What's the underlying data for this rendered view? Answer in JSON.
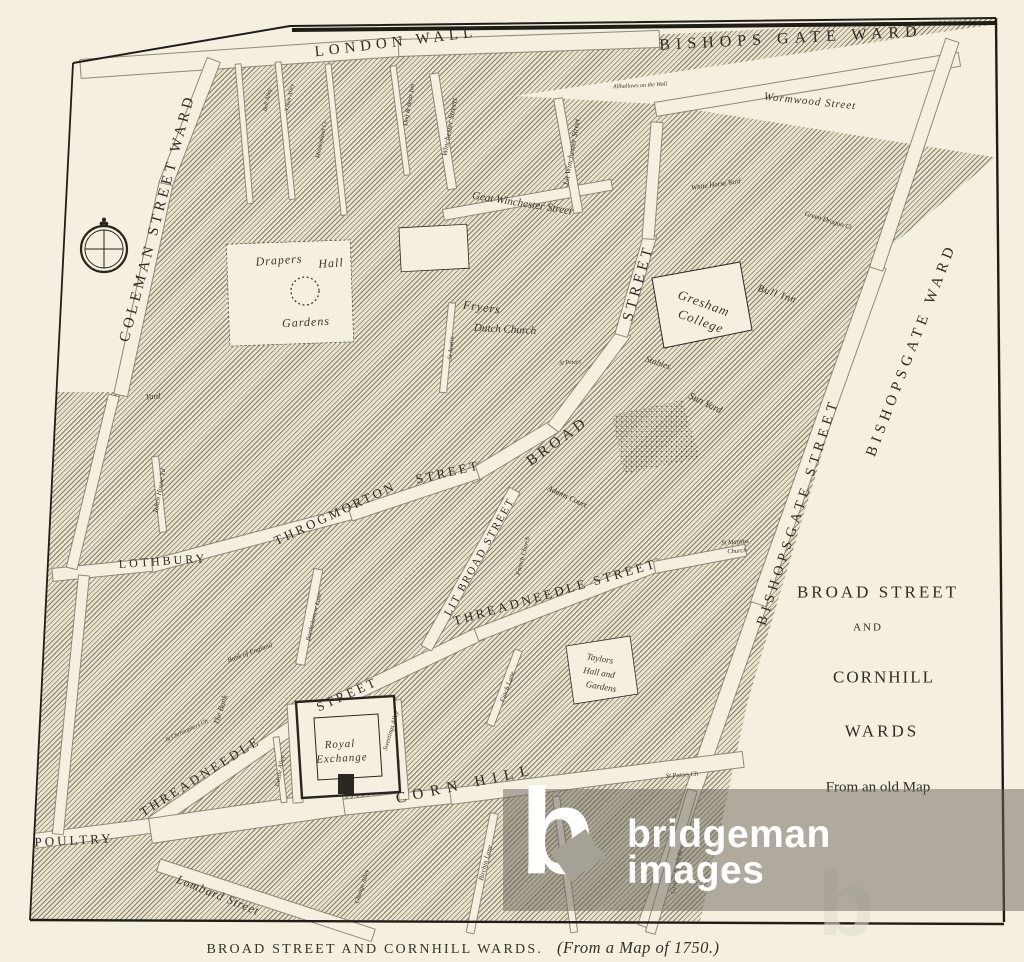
{
  "caption": {
    "title": "BROAD STREET AND CORNHILL WARDS.",
    "source": "(From a Map of 1750.)"
  },
  "watermark": {
    "logo_letter": "b",
    "line1": "bridgeman",
    "line2": "images",
    "ghost_letter": "b"
  },
  "map": {
    "labels": [
      {
        "t": "LONDON WALL",
        "x": 396,
        "y": 43,
        "r": -7,
        "s": 15,
        "ls": 5,
        "st": "c"
      },
      {
        "t": "BISHOPS GATE WARD",
        "x": 791,
        "y": 39,
        "r": -3,
        "s": 16,
        "ls": 6,
        "st": "c"
      },
      {
        "t": "COLEMAN STREET WARD",
        "x": 158,
        "y": 218,
        "r": -75,
        "s": 15,
        "ls": 4,
        "st": "c"
      },
      {
        "t": "BISHOPSGATE STREET",
        "x": 799,
        "y": 512,
        "r": -72,
        "s": 14,
        "ls": 5,
        "st": "c"
      },
      {
        "t": "BISHOPSGATE WARD",
        "x": 912,
        "y": 350,
        "r": -69,
        "s": 15,
        "ls": 5,
        "st": "c"
      },
      {
        "t": "BROAD",
        "x": 558,
        "y": 442,
        "r": -36,
        "s": 15,
        "ls": 4,
        "st": "c"
      },
      {
        "t": "STREET",
        "x": 639,
        "y": 283,
        "r": -74,
        "s": 15,
        "ls": 4,
        "st": "c"
      },
      {
        "t": "THROGMORTON",
        "x": 335,
        "y": 513,
        "r": -25,
        "s": 13,
        "ls": 3,
        "st": "c"
      },
      {
        "t": "STREET",
        "x": 448,
        "y": 472,
        "r": -13,
        "s": 13,
        "ls": 3,
        "st": "c"
      },
      {
        "t": "LOTHBURY",
        "x": 163,
        "y": 561,
        "r": -4,
        "s": 12,
        "ls": 3,
        "st": "c"
      },
      {
        "t": "LIT BROAD STREET",
        "x": 480,
        "y": 557,
        "r": -61,
        "s": 11,
        "ls": 2,
        "st": "c"
      },
      {
        "t": "THREADNEEDLE STREET",
        "x": 555,
        "y": 592,
        "r": -16,
        "s": 13,
        "ls": 3,
        "st": "c"
      },
      {
        "t": "THREADNEEDLE",
        "x": 200,
        "y": 776,
        "r": -32,
        "s": 13,
        "ls": 3,
        "st": "c"
      },
      {
        "t": "STREET",
        "x": 347,
        "y": 694,
        "r": -24,
        "s": 13,
        "ls": 3,
        "st": "c"
      },
      {
        "t": "CORN HILL",
        "x": 466,
        "y": 785,
        "r": -12,
        "s": 15,
        "ls": 7,
        "st": "c"
      },
      {
        "t": "POULTRY",
        "x": 74,
        "y": 840,
        "r": -3,
        "s": 13,
        "ls": 3,
        "st": "c"
      },
      {
        "t": "BROAD STREET",
        "x": 878,
        "y": 592,
        "r": 0,
        "s": 17,
        "ls": 3,
        "st": "c"
      },
      {
        "t": "AND",
        "x": 868,
        "y": 628,
        "r": 0,
        "s": 11,
        "ls": 2,
        "st": "c"
      },
      {
        "t": "CORNHILL",
        "x": 884,
        "y": 677,
        "r": 0,
        "s": 17,
        "ls": 2,
        "st": "c"
      },
      {
        "t": "WARDS",
        "x": 882,
        "y": 731,
        "r": 0,
        "s": 17,
        "ls": 3,
        "st": "c"
      },
      {
        "t": "From an old Map",
        "x": 878,
        "y": 788,
        "r": 0,
        "s": 15,
        "ls": 0,
        "st": "p"
      },
      {
        "t": "Wormwood Street",
        "x": 810,
        "y": 102,
        "r": 6,
        "s": 11,
        "ls": 1,
        "st": "s"
      },
      {
        "t": "Allhallows on the Wall",
        "x": 640,
        "y": 86,
        "r": -3,
        "s": 6,
        "ls": 0,
        "st": "s"
      },
      {
        "t": "Geat Winchester Street",
        "x": 522,
        "y": 204,
        "r": 9,
        "s": 11,
        "ls": 0,
        "st": "s"
      },
      {
        "t": "Lit Winchester Street",
        "x": 572,
        "y": 152,
        "r": -80,
        "s": 8,
        "ls": 0,
        "st": "s"
      },
      {
        "t": "Winchester Streets",
        "x": 450,
        "y": 127,
        "r": -80,
        "s": 8,
        "ls": 0,
        "st": "s"
      },
      {
        "t": "Dog & Bear Inn",
        "x": 410,
        "y": 105,
        "r": -80,
        "s": 6.5,
        "ls": 0,
        "st": "s"
      },
      {
        "t": "Drapers",
        "x": 279,
        "y": 260,
        "r": -4,
        "s": 12,
        "ls": 1,
        "st": "s"
      },
      {
        "t": "Hall",
        "x": 331,
        "y": 263,
        "r": -4,
        "s": 12,
        "ls": 1,
        "st": "s"
      },
      {
        "t": "Gardens",
        "x": 306,
        "y": 322,
        "r": -3,
        "s": 12,
        "ls": 1,
        "st": "s"
      },
      {
        "t": "Fryers",
        "x": 482,
        "y": 307,
        "r": 8,
        "s": 12,
        "ls": 1,
        "st": "s"
      },
      {
        "t": "Dutch Church",
        "x": 505,
        "y": 330,
        "r": 3,
        "s": 11,
        "ls": 0,
        "st": "s"
      },
      {
        "t": "St Austin",
        "x": 452,
        "y": 348,
        "r": -85,
        "s": 6.5,
        "ls": 0,
        "st": "s"
      },
      {
        "t": "Gresham",
        "x": 704,
        "y": 303,
        "r": 20,
        "s": 13,
        "ls": 1,
        "st": "s"
      },
      {
        "t": "College",
        "x": 701,
        "y": 321,
        "r": 20,
        "s": 13,
        "ls": 1,
        "st": "s"
      },
      {
        "t": "Bull Inn",
        "x": 777,
        "y": 295,
        "r": 18,
        "s": 10,
        "ls": 1,
        "st": "s"
      },
      {
        "t": "Stables",
        "x": 658,
        "y": 363,
        "r": 19,
        "s": 9,
        "ls": 0,
        "st": "s"
      },
      {
        "t": "Sun Yard",
        "x": 705,
        "y": 404,
        "r": 26,
        "s": 10,
        "ls": 0,
        "st": "s"
      },
      {
        "t": "Adams Court",
        "x": 567,
        "y": 497,
        "r": 25,
        "s": 8,
        "ls": 0,
        "st": "s"
      },
      {
        "t": "French Church",
        "x": 524,
        "y": 556,
        "r": -75,
        "s": 6.5,
        "ls": 0,
        "st": "s"
      },
      {
        "t": "St Martins",
        "x": 735,
        "y": 543,
        "r": -4,
        "s": 6.5,
        "ls": 0,
        "st": "s"
      },
      {
        "t": "Church",
        "x": 737,
        "y": 552,
        "r": -4,
        "s": 6.5,
        "ls": 0,
        "st": "s"
      },
      {
        "t": "Taylors",
        "x": 600,
        "y": 659,
        "r": 10,
        "s": 9,
        "ls": 0,
        "st": "s"
      },
      {
        "t": "Hall and",
        "x": 599,
        "y": 673,
        "r": 10,
        "s": 9,
        "ls": 0,
        "st": "s"
      },
      {
        "t": "Gardens",
        "x": 601,
        "y": 687,
        "r": 10,
        "s": 9,
        "ls": 0,
        "st": "s"
      },
      {
        "t": "Royal",
        "x": 340,
        "y": 745,
        "r": -3,
        "s": 11,
        "ls": 1,
        "st": "s"
      },
      {
        "t": "Exchange",
        "x": 342,
        "y": 759,
        "r": -3,
        "s": 11,
        "ls": 1,
        "st": "s"
      },
      {
        "t": "Lombard Street",
        "x": 218,
        "y": 895,
        "r": 22,
        "s": 12,
        "ls": 1,
        "st": "s"
      },
      {
        "t": "Birchin Lane",
        "x": 486,
        "y": 863,
        "r": -75,
        "s": 7,
        "ls": 0,
        "st": "s"
      },
      {
        "t": "Finch Lane",
        "x": 508,
        "y": 687,
        "r": -70,
        "s": 7,
        "ls": 0,
        "st": "s"
      },
      {
        "t": "Change Alley",
        "x": 363,
        "y": 887,
        "r": -72,
        "s": 6.5,
        "ls": 0,
        "st": "s"
      },
      {
        "t": "Castle Alley",
        "x": 281,
        "y": 771,
        "r": -80,
        "s": 6.5,
        "ls": 0,
        "st": "s"
      },
      {
        "t": "Sweetings Alley",
        "x": 392,
        "y": 731,
        "r": -73,
        "s": 6.5,
        "ls": 0,
        "st": "s"
      },
      {
        "t": "Bartholomew Lane",
        "x": 315,
        "y": 617,
        "r": -76,
        "s": 6.5,
        "ls": 0,
        "st": "s"
      },
      {
        "t": "Bank of England",
        "x": 250,
        "y": 653,
        "r": -20,
        "s": 7,
        "ls": 0,
        "st": "s"
      },
      {
        "t": "The Bank",
        "x": 221,
        "y": 710,
        "r": -72,
        "s": 8,
        "ls": 0,
        "st": "s"
      },
      {
        "t": "Token House Yd",
        "x": 160,
        "y": 491,
        "r": -80,
        "s": 7,
        "ls": 0,
        "st": "s"
      },
      {
        "t": "Yard",
        "x": 153,
        "y": 397,
        "r": -5,
        "s": 8,
        "ls": 0,
        "st": "s"
      },
      {
        "t": "St Peters Ch",
        "x": 682,
        "y": 776,
        "r": -4,
        "s": 6.5,
        "ls": 0,
        "st": "s"
      },
      {
        "t": "Gracechurch St",
        "x": 677,
        "y": 872,
        "r": -80,
        "s": 7,
        "ls": 0,
        "st": "s"
      },
      {
        "t": "St Christophers Ch",
        "x": 187,
        "y": 731,
        "r": -25,
        "s": 6,
        "ls": 0,
        "st": "s"
      },
      {
        "t": "Bell Alley",
        "x": 268,
        "y": 100,
        "r": -78,
        "s": 6,
        "ls": 0,
        "st": "s"
      },
      {
        "t": "3 Nun Alley",
        "x": 290,
        "y": 98,
        "r": -78,
        "s": 6,
        "ls": 0,
        "st": "s"
      },
      {
        "t": "Maidenhead Ct",
        "x": 322,
        "y": 140,
        "r": -78,
        "s": 6,
        "ls": 0,
        "st": "s"
      },
      {
        "t": "White Horse Yard",
        "x": 716,
        "y": 185,
        "r": -8,
        "s": 7,
        "ls": 0,
        "st": "s"
      },
      {
        "t": "Green Dragon Ct",
        "x": 828,
        "y": 221,
        "r": 17,
        "s": 7,
        "ls": 0,
        "st": "s"
      },
      {
        "t": "St Peters",
        "x": 570,
        "y": 363,
        "r": -4,
        "s": 6,
        "ls": 0,
        "st": "s"
      }
    ]
  }
}
